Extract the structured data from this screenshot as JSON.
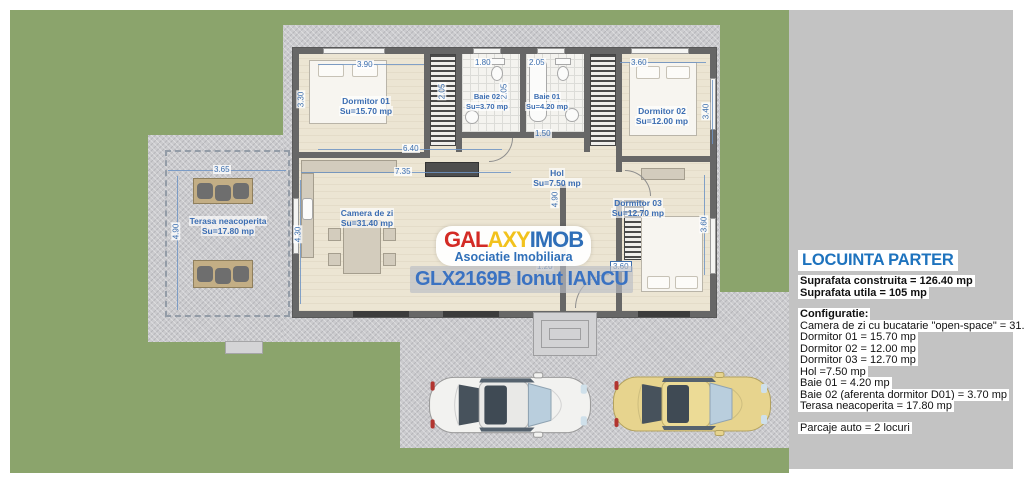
{
  "panel": {
    "title": "LOCUINTA PARTER",
    "built": "Suprafata construita = 126.40 mp",
    "usable": "Suprafata utila = 105 mp",
    "config_heading": "Configuratie:",
    "config": [
      "Camera de zi cu bucatarie \"open-space\" = 31.40 mp",
      "Dormitor 01 = 15.70 mp",
      "Dormitor 02 = 12.00 mp",
      "Dormitor 03 = 12.70 mp",
      "Hol =7.50 mp",
      "Baie 01 = 4.20 mp",
      "Baie 02 (aferenta dormitor D01) = 3.70 mp",
      "Terasa neacoperita = 17.80 mp"
    ],
    "parking": "Parcaje auto = 2 locuri"
  },
  "watermark": {
    "brand": {
      "red": "GAL",
      "yellow": "AXY",
      "blue": "IMOB"
    },
    "subtitle": "Asociatie Imobiliara",
    "listing": "GLX2169B Ionut IANCU"
  },
  "rooms": [
    {
      "name": "Dormitor 01",
      "area": "Su=15.70 mp"
    },
    {
      "name": "Baie 02",
      "area": "Su=3.70 mp"
    },
    {
      "name": "Baie 01",
      "area": "Su=4.20 mp"
    },
    {
      "name": "Dormitor 02",
      "area": "Su=12.00 mp"
    },
    {
      "name": "Camera de zi",
      "area": "Su=31.40 mp"
    },
    {
      "name": "Hol",
      "area": "Su=7.50 mp"
    },
    {
      "name": "Dormitor 03",
      "area": "Su=12.70 mp"
    },
    {
      "name": "Terasa neacoperita",
      "area": "Su=17.80 mp"
    }
  ],
  "dimensions": [
    "3.90",
    "3.30",
    "1.80",
    "2.05",
    "2.05",
    "2.05",
    "3.60",
    "3.40",
    "6.40",
    "7.35",
    "1.50",
    "4.30",
    "4.90",
    "1.20",
    "3.60",
    "3.60",
    "3.65",
    "4.90"
  ],
  "colors": {
    "lawn": "#8ba46c",
    "paving": "#cbcbce",
    "panel_bg": "#c3c3c3",
    "wall": "#676767",
    "floor": "#ece5d3",
    "annotation_blue": "#3d6fae",
    "title_blue": "#1e73be",
    "brand_red": "#d32b25",
    "brand_yellow": "#f2c21c",
    "brand_blue": "#2f6fb8",
    "car_white": "#f2f2f0",
    "car_yellow": "#e7d48e"
  }
}
